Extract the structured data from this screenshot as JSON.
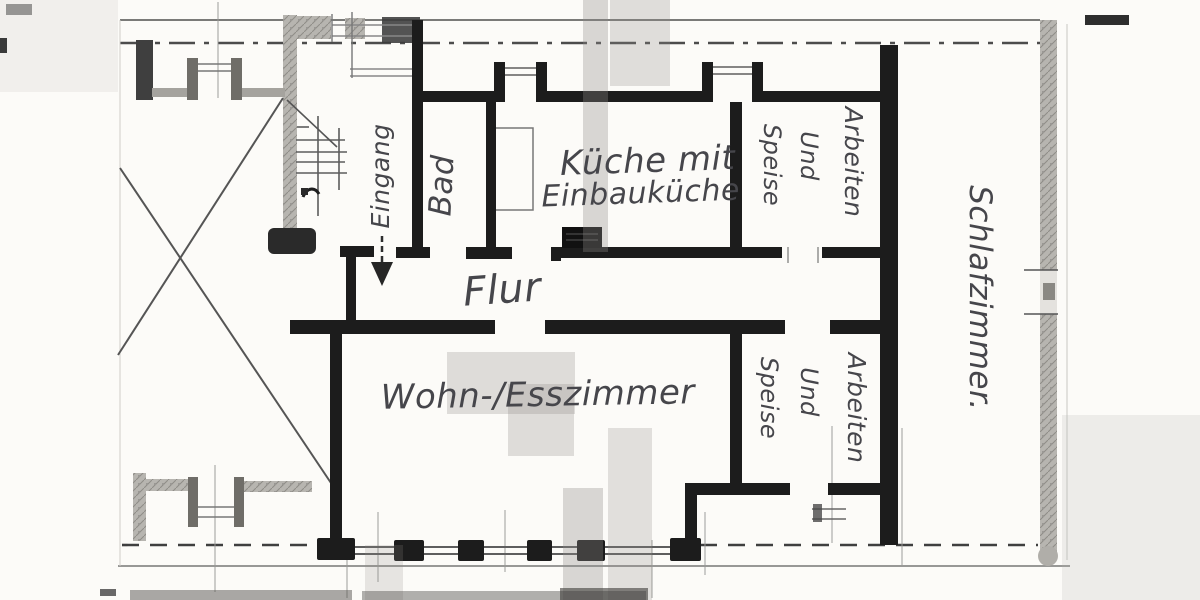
{
  "floor_plan": {
    "rooms": {
      "eingang": {
        "label": "Eingang"
      },
      "bad": {
        "label": "Bad"
      },
      "kueche": {
        "line1": "Küche mit",
        "line2": "Einbauküche"
      },
      "speise_top": {
        "lines": [
          "Speise",
          "Und",
          "Arbeiten"
        ]
      },
      "schlafzimmer": {
        "label": "Schlafzimmer."
      },
      "flur": {
        "label": "Flur"
      },
      "wohn_esszimmer": {
        "label": "Wohn-/Esszimmer"
      },
      "speise_bottom": {
        "lines": [
          "Speise",
          "Und",
          "Arbeiten"
        ]
      }
    },
    "colors": {
      "paper": "#fcfbf8",
      "wall": "#1c1c1c",
      "hatch_gray": "#b7b5b0",
      "pencil_text": "#46464b",
      "thin_line": "#777777"
    }
  }
}
